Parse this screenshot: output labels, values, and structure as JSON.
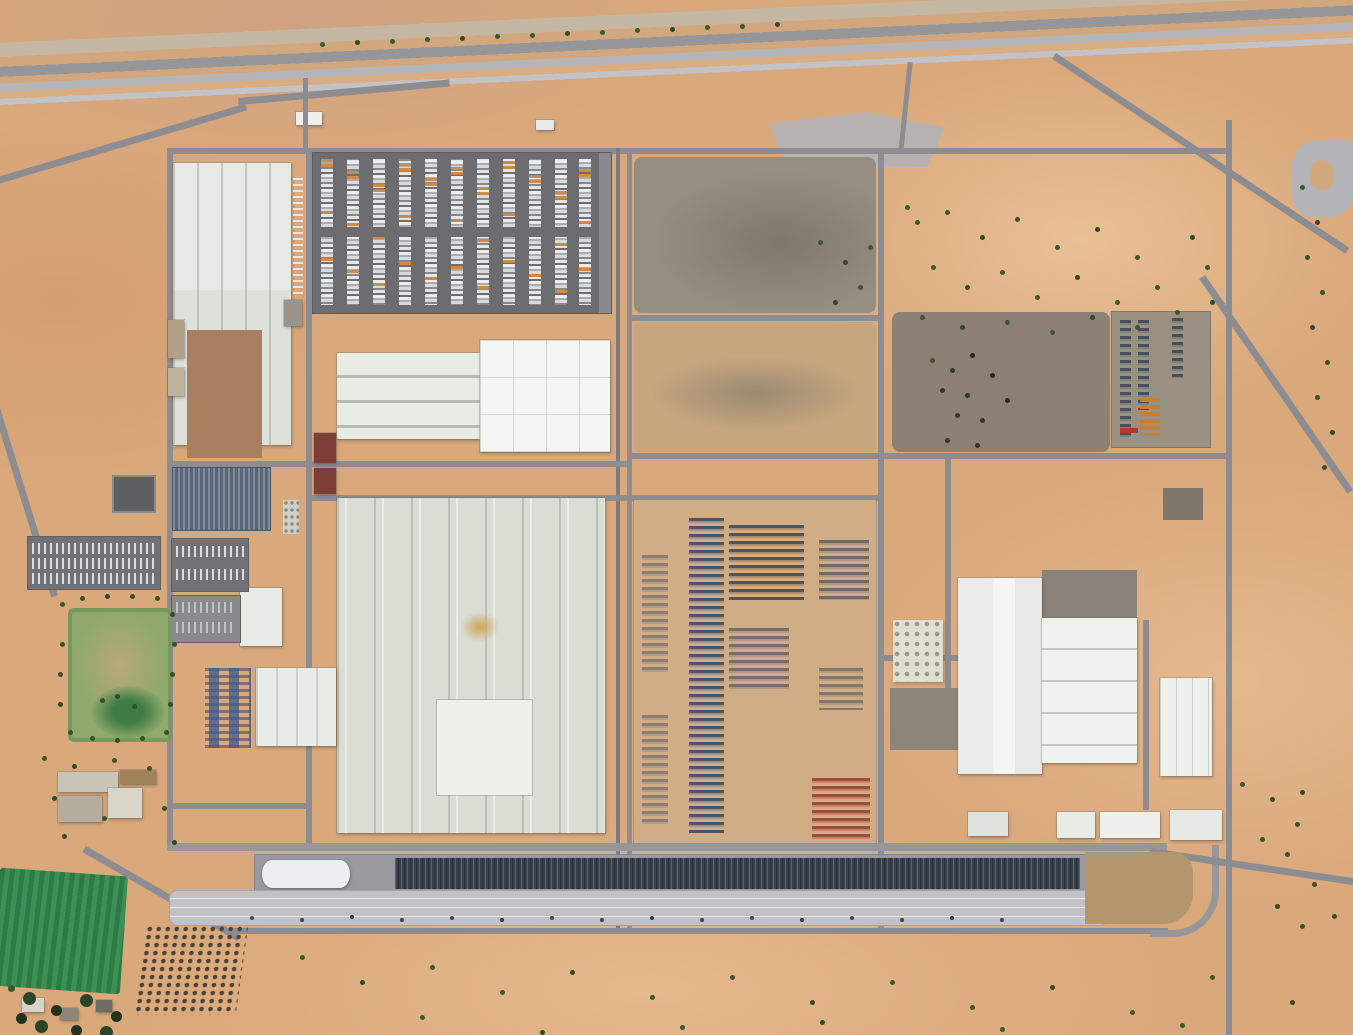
{
  "scene": {
    "view": "satellite aerial view",
    "site": "large industrial manufacturing complex",
    "terrain": "arid tan farmland with scattered trees"
  },
  "palette": {
    "desert": "#d9a87b",
    "road_gray": "#8d8d91",
    "asphalt_dark": "#6d6d71",
    "building_white": "#f4f6f2",
    "building_light": "#e3e7e1",
    "roof_brown": "#a87f5f",
    "crop_green": "#2f8049",
    "tree_green": "#3b5631",
    "car_mass_navy": "#39414d",
    "track_gray": "#c2c2c6",
    "container_orange": "#c87f35",
    "red_roof": "#7e3e38"
  },
  "features": {
    "highway_corridor": {
      "label": "highway and rail corridor"
    },
    "entrance": {
      "label": "plant entrance and gatehouse"
    },
    "north_parking": {
      "label": "north parking lot with rows of cars"
    },
    "west_building": {
      "label": "west factory hall with brown roof section"
    },
    "press_hall": {
      "label": "central hall with skylight strips"
    },
    "white_hall": {
      "label": "bright white hall"
    },
    "main_hall": {
      "label": "main assembly hall"
    },
    "west_annex": {
      "label": "west annex hall"
    },
    "north_lot": {
      "label": "graded dark dirt lot"
    },
    "mid_lot": {
      "label": "graded tan dirt lot"
    },
    "east_lot": {
      "label": "dark graded lot with trees"
    },
    "vehicle_yard": {
      "label": "finished vehicle storage yard"
    },
    "east_complex": {
      "label": "east production halls"
    },
    "container_yard": {
      "label": "east car park with orange containers"
    },
    "pond": {
      "label": "dark basin"
    },
    "panel_strip": {
      "label": "blue panel / car strip"
    },
    "west_parking": {
      "label": "west parking rows"
    },
    "sports_field": {
      "label": "green sports field"
    },
    "blue_cars": {
      "label": "blue car rows"
    },
    "sw_buildings": {
      "label": "southwest service buildings"
    },
    "holding_strip": {
      "label": "vehicle holding lanes"
    },
    "car_train": {
      "label": "dense row of dark vehicles"
    },
    "canopy": {
      "label": "white canopy"
    },
    "test_track": {
      "label": "test track straight"
    },
    "green_field": {
      "label": "irrigated green crop field"
    },
    "orchard": {
      "label": "orchard tree grid"
    },
    "village": {
      "label": "farm building cluster"
    },
    "loop": {
      "label": "gravel loop area"
    }
  }
}
